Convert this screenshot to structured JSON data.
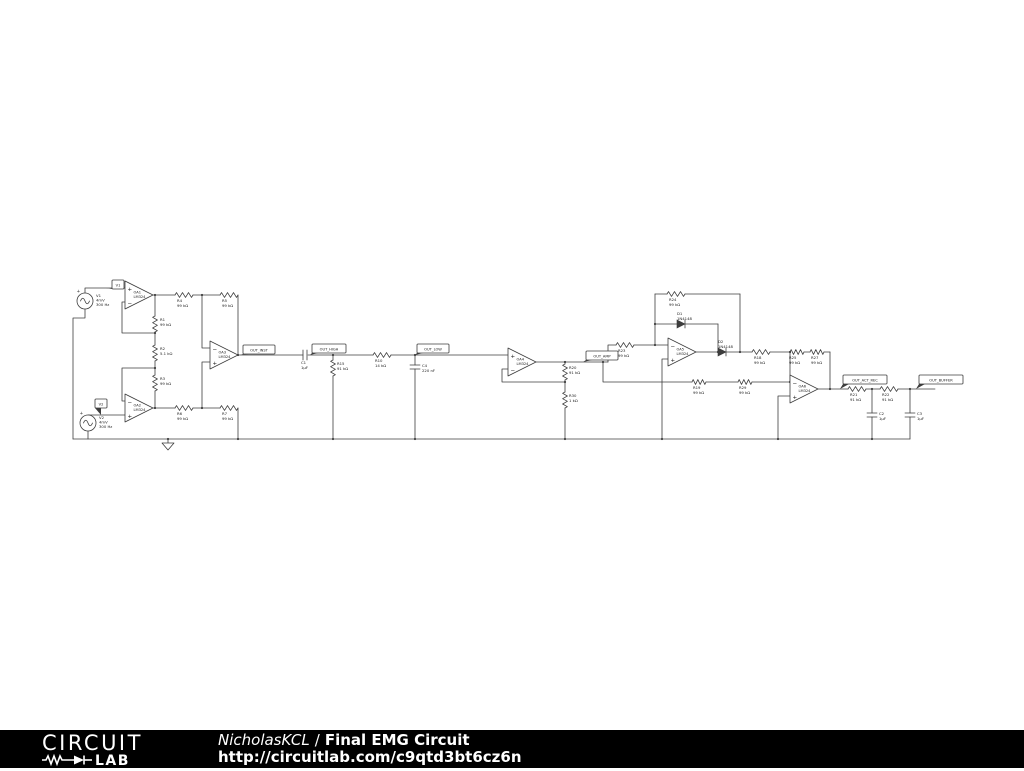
{
  "footer": {
    "logo": {
      "line1": "CIRCUIT",
      "line2": "LAB"
    },
    "author": "NicholasKCL",
    "separator": "/",
    "title": "Final EMG Circuit",
    "url": "http://circuitlab.com/c9qtd3bt6cz6n"
  },
  "schematic": {
    "stroke": "#3d3d3d",
    "text_color": "#1a1a1a",
    "wires": [
      [
        85,
        293,
        85,
        288,
        125,
        288
      ],
      [
        85,
        309,
        85,
        318,
        73,
        318,
        73,
        439
      ],
      [
        73,
        439,
        910,
        439
      ],
      [
        125,
        302,
        122,
        302,
        122,
        333,
        155,
        333
      ],
      [
        153,
        295,
        175,
        295
      ],
      [
        155,
        295,
        155,
        316
      ],
      [
        193,
        295,
        220,
        295
      ],
      [
        202,
        295,
        202,
        348,
        210,
        348
      ],
      [
        238,
        295,
        238,
        355
      ],
      [
        238,
        355,
        303,
        355
      ],
      [
        308,
        355,
        373,
        355
      ],
      [
        391,
        355,
        508,
        355
      ],
      [
        333,
        355,
        333,
        360
      ],
      [
        333,
        376,
        333,
        439
      ],
      [
        415,
        355,
        415,
        365
      ],
      [
        415,
        369,
        415,
        439
      ],
      [
        125,
        401,
        122,
        401,
        122,
        368,
        155,
        368
      ],
      [
        88,
        415,
        125,
        415
      ],
      [
        88,
        431,
        88,
        439
      ],
      [
        153,
        408,
        175,
        408
      ],
      [
        155,
        391,
        155,
        408
      ],
      [
        193,
        408,
        220,
        408
      ],
      [
        202,
        408,
        202,
        362,
        210,
        362
      ],
      [
        238,
        408,
        238,
        439
      ],
      [
        155,
        332,
        155,
        345
      ],
      [
        155,
        361,
        155,
        375
      ],
      [
        508,
        369,
        502,
        369,
        502,
        382,
        565,
        382
      ],
      [
        536,
        362,
        608,
        362
      ],
      [
        608,
        362,
        608,
        345,
        616,
        345
      ],
      [
        603,
        362,
        603,
        382,
        692,
        382
      ],
      [
        565,
        362,
        565,
        364
      ],
      [
        565,
        380,
        565,
        392
      ],
      [
        565,
        408,
        565,
        439
      ],
      [
        634,
        345,
        668,
        345
      ],
      [
        655,
        345,
        655,
        294
      ],
      [
        655,
        294,
        667,
        294
      ],
      [
        685,
        294,
        740,
        294
      ],
      [
        740,
        294,
        740,
        352
      ],
      [
        655,
        324,
        677,
        324
      ],
      [
        685,
        324,
        718,
        324
      ],
      [
        718,
        324,
        718,
        352
      ],
      [
        668,
        359,
        662,
        359,
        662,
        439
      ],
      [
        696,
        352,
        718,
        352
      ],
      [
        726,
        352,
        752,
        352
      ],
      [
        770,
        352,
        790,
        352
      ],
      [
        790,
        352,
        790,
        382
      ],
      [
        706,
        382,
        738,
        382
      ],
      [
        752,
        382,
        790,
        382
      ],
      [
        804,
        352,
        810,
        352
      ],
      [
        824,
        352,
        830,
        352
      ],
      [
        830,
        352,
        830,
        389
      ],
      [
        790,
        396,
        778,
        396,
        778,
        439
      ],
      [
        818,
        389,
        848,
        389
      ],
      [
        866,
        389,
        880,
        389
      ],
      [
        872,
        389,
        872,
        413
      ],
      [
        872,
        417,
        872,
        439
      ],
      [
        898,
        389,
        935,
        389
      ],
      [
        910,
        389,
        910,
        413
      ],
      [
        910,
        417,
        910,
        439
      ],
      [
        168,
        439,
        168,
        443
      ]
    ],
    "dots": [
      [
        155,
        295
      ],
      [
        202,
        295
      ],
      [
        155,
        333
      ],
      [
        155,
        368
      ],
      [
        155,
        408
      ],
      [
        202,
        408
      ],
      [
        238,
        355
      ],
      [
        238,
        439
      ],
      [
        333,
        355
      ],
      [
        333,
        439
      ],
      [
        415,
        355
      ],
      [
        415,
        439
      ],
      [
        565,
        362
      ],
      [
        565,
        382
      ],
      [
        565,
        439
      ],
      [
        603,
        362
      ],
      [
        655,
        345
      ],
      [
        655,
        324
      ],
      [
        718,
        352
      ],
      [
        740,
        352
      ],
      [
        790,
        352
      ],
      [
        790,
        382
      ],
      [
        830,
        389
      ],
      [
        872,
        389
      ],
      [
        910,
        389
      ],
      [
        872,
        439
      ],
      [
        662,
        439
      ],
      [
        778,
        439
      ],
      [
        168,
        439
      ]
    ],
    "resistors": [
      {
        "name": "R1",
        "value": "99 kΩ",
        "x": 155,
        "y": 316,
        "len": 16,
        "o": "v",
        "lx": 160,
        "ly": 321
      },
      {
        "name": "R2",
        "value": "5.1 kΩ",
        "x": 155,
        "y": 345,
        "len": 16,
        "o": "v",
        "lx": 160,
        "ly": 350
      },
      {
        "name": "R3",
        "value": "99 kΩ",
        "x": 155,
        "y": 375,
        "len": 16,
        "o": "v",
        "lx": 160,
        "ly": 380
      },
      {
        "name": "R4",
        "value": "99 kΩ",
        "x": 175,
        "y": 295,
        "len": 18,
        "o": "h",
        "lx": 177,
        "ly": 302
      },
      {
        "name": "R5",
        "value": "99 kΩ",
        "x": 220,
        "y": 295,
        "len": 18,
        "o": "h",
        "lx": 222,
        "ly": 302
      },
      {
        "name": "R6",
        "value": "99 kΩ",
        "x": 175,
        "y": 408,
        "len": 18,
        "o": "h",
        "lx": 177,
        "ly": 415
      },
      {
        "name": "R7",
        "value": "99 kΩ",
        "x": 220,
        "y": 408,
        "len": 18,
        "o": "h",
        "lx": 222,
        "ly": 415
      },
      {
        "name": "R15",
        "value": "91 kΩ",
        "x": 333,
        "y": 360,
        "len": 16,
        "o": "v",
        "lx": 337,
        "ly": 365
      },
      {
        "name": "R10",
        "value": "14 kΩ",
        "x": 373,
        "y": 355,
        "len": 18,
        "o": "h",
        "lx": 375,
        "ly": 362
      },
      {
        "name": "R20",
        "value": "91 kΩ",
        "x": 565,
        "y": 364,
        "len": 16,
        "o": "v",
        "lx": 569,
        "ly": 369
      },
      {
        "name": "R30",
        "value": "1 kΩ",
        "x": 565,
        "y": 392,
        "len": 16,
        "o": "v",
        "lx": 569,
        "ly": 397
      },
      {
        "name": "R23",
        "value": "99 kΩ",
        "x": 616,
        "y": 345,
        "len": 18,
        "o": "h",
        "lx": 618,
        "ly": 352
      },
      {
        "name": "R24",
        "value": "99 kΩ",
        "x": 667,
        "y": 294,
        "len": 18,
        "o": "h",
        "lx": 669,
        "ly": 301
      },
      {
        "name": "R18",
        "value": "99 kΩ",
        "x": 752,
        "y": 352,
        "len": 18,
        "o": "h",
        "lx": 754,
        "ly": 359
      },
      {
        "name": "R19",
        "value": "99 kΩ",
        "x": 692,
        "y": 382,
        "len": 14,
        "o": "h",
        "lx": 693,
        "ly": 389
      },
      {
        "name": "R29",
        "value": "99 kΩ",
        "x": 738,
        "y": 382,
        "len": 14,
        "o": "h",
        "lx": 739,
        "ly": 389
      },
      {
        "name": "R25",
        "value": "99 kΩ",
        "x": 790,
        "y": 352,
        "len": 14,
        "o": "h",
        "lx": 789,
        "ly": 359
      },
      {
        "name": "R27",
        "value": "99 kΩ",
        "x": 810,
        "y": 352,
        "len": 14,
        "o": "h",
        "lx": 811,
        "ly": 359
      },
      {
        "name": "R21",
        "value": "91 kΩ",
        "x": 848,
        "y": 389,
        "len": 18,
        "o": "h",
        "lx": 850,
        "ly": 396
      },
      {
        "name": "R22",
        "value": "91 kΩ",
        "x": 880,
        "y": 389,
        "len": 18,
        "o": "h",
        "lx": 882,
        "ly": 396
      }
    ],
    "capacitors": [
      {
        "name": "C1",
        "value": "1µF",
        "x": 303,
        "y": 355,
        "o": "h",
        "lx": 301,
        "ly": 364
      },
      {
        "name": "C4",
        "value": "220 nF",
        "x": 415,
        "y": 365,
        "o": "v",
        "lx": 422,
        "ly": 367
      },
      {
        "name": "C2",
        "value": "1µF",
        "x": 872,
        "y": 413,
        "o": "v",
        "lx": 879,
        "ly": 415
      },
      {
        "name": "C3",
        "value": "1µF",
        "x": 910,
        "y": 413,
        "o": "v",
        "lx": 917,
        "ly": 415
      }
    ],
    "diodes": [
      {
        "name": "D1",
        "value": "1N4148",
        "x": 677,
        "y": 324,
        "lx": 677,
        "ly": 315
      },
      {
        "name": "D2",
        "value": "1N4148",
        "x": 718,
        "y": 352,
        "lx": 718,
        "ly": 343
      }
    ],
    "opamps": [
      {
        "name": "OA1",
        "part": "LM324",
        "x": 125,
        "y": 281,
        "plus": "top"
      },
      {
        "name": "OA2",
        "part": "LM324",
        "x": 125,
        "y": 394,
        "plus": "bottom"
      },
      {
        "name": "OA3",
        "part": "LM324",
        "x": 210,
        "y": 341,
        "plus": "bottom"
      },
      {
        "name": "OA4",
        "part": "LM324",
        "x": 508,
        "y": 348,
        "plus": "top"
      },
      {
        "name": "OA5",
        "part": "LM324",
        "x": 668,
        "y": 338,
        "plus": "bottom"
      },
      {
        "name": "OA6",
        "part": "LM324",
        "x": 790,
        "y": 375,
        "plus": "bottom"
      }
    ],
    "sources": [
      {
        "name": "V1",
        "cx": 85,
        "cy": 301,
        "r": 8,
        "lines": [
          "V1",
          "4mV",
          "300 Hz"
        ],
        "lx": 96,
        "ly": 297
      },
      {
        "name": "V2",
        "cx": 88,
        "cy": 423,
        "r": 8,
        "lines": [
          "V2",
          "4mV",
          "300 Hz"
        ],
        "lx": 99,
        "ly": 419
      }
    ],
    "flags": [
      {
        "text": "V1",
        "x": 112,
        "y": 280,
        "w": 12,
        "h": 9,
        "ax": 106,
        "ay": 288
      },
      {
        "text": "V2",
        "x": 95,
        "y": 399,
        "w": 12,
        "h": 9,
        "ax": 101,
        "ay": 415
      },
      {
        "text": "OUT_INST",
        "x": 243,
        "y": 345,
        "w": 32,
        "h": 9,
        "ax": 240,
        "ay": 355
      },
      {
        "text": "OUT_HIGH",
        "x": 312,
        "y": 344,
        "w": 34,
        "h": 9,
        "ax": 310,
        "ay": 355
      },
      {
        "text": "OUT_LOW",
        "x": 417,
        "y": 344,
        "w": 32,
        "h": 9,
        "ax": 415,
        "ay": 355
      },
      {
        "text": "OUT_AMP",
        "x": 586,
        "y": 351,
        "w": 32,
        "h": 9,
        "ax": 583,
        "ay": 362
      },
      {
        "text": "OUT_ACT_REC",
        "x": 843,
        "y": 375,
        "w": 44,
        "h": 9,
        "ax": 840,
        "ay": 389
      },
      {
        "text": "OUT_BUFFER",
        "x": 919,
        "y": 375,
        "w": 44,
        "h": 9,
        "ax": 916,
        "ay": 389
      }
    ],
    "grounds": [
      [
        168,
        443
      ]
    ]
  }
}
